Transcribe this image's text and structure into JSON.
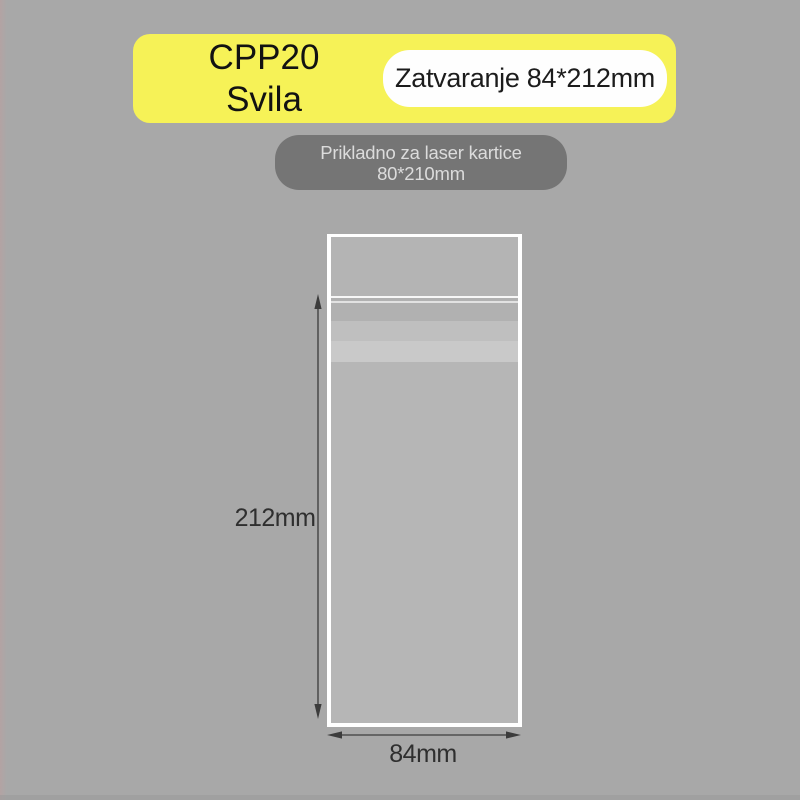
{
  "banner": {
    "product_line1": "CPP20",
    "product_line2": "Svila",
    "closure_label": "Zatvaranje 84*212mm"
  },
  "info_pill": {
    "line1": "Prikladno za laser kartice",
    "line2": "80*210mm"
  },
  "diagram": {
    "height_label": "212mm",
    "width_label": "84mm"
  },
  "colors": {
    "background": "#a8a8a8",
    "banner_yellow": "#f6f257",
    "closure_pill": "#fefefe",
    "info_pill_gray": "#757575",
    "info_pill_text": "#dcdcdc",
    "bag_border": "#ffffff",
    "bag_flap": "#b4b4b4",
    "bag_body": "#b6b6b6",
    "adhesive_band_light": "#bfbfbf",
    "adhesive_band_lighter": "#c9c9c9",
    "dimension_ink": "#2f2f2f",
    "arrow_stroke": "#4f4f4f"
  }
}
